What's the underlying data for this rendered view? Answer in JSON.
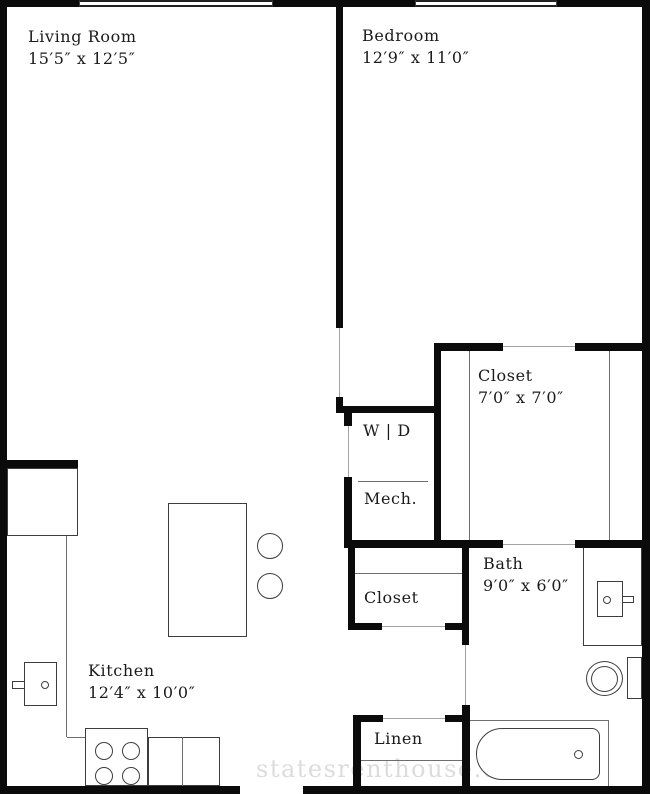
{
  "plan_title": "apartment-floor-plan",
  "rooms": {
    "living_room": {
      "name": "Living Room",
      "dims": "15′5″ x 12′5″"
    },
    "bedroom": {
      "name": "Bedroom",
      "dims": "12′9″ x 11′0″"
    },
    "closet_main": {
      "name": "Closet",
      "dims": "7′0″ x 7′0″"
    },
    "bath": {
      "name": "Bath",
      "dims": "9′0″ x 6′0″"
    },
    "kitchen": {
      "name": "Kitchen",
      "dims": "12′4″ x 10′0″"
    },
    "washer_dryer": {
      "name": "W | D"
    },
    "mechanical": {
      "name": "Mech."
    },
    "closet_hall": {
      "name": "Closet"
    },
    "linen": {
      "name": "Linen"
    }
  },
  "watermark": {
    "text": "statesrenthouse.com"
  },
  "colors": {
    "wall": "#0b0b0b",
    "fixture_line": "#3d3d3d",
    "door_opening_dash": "#a3a3a3",
    "label_text": "#1b1b1b",
    "watermark_text": "#dcdcdc",
    "background": "#ffffff"
  }
}
